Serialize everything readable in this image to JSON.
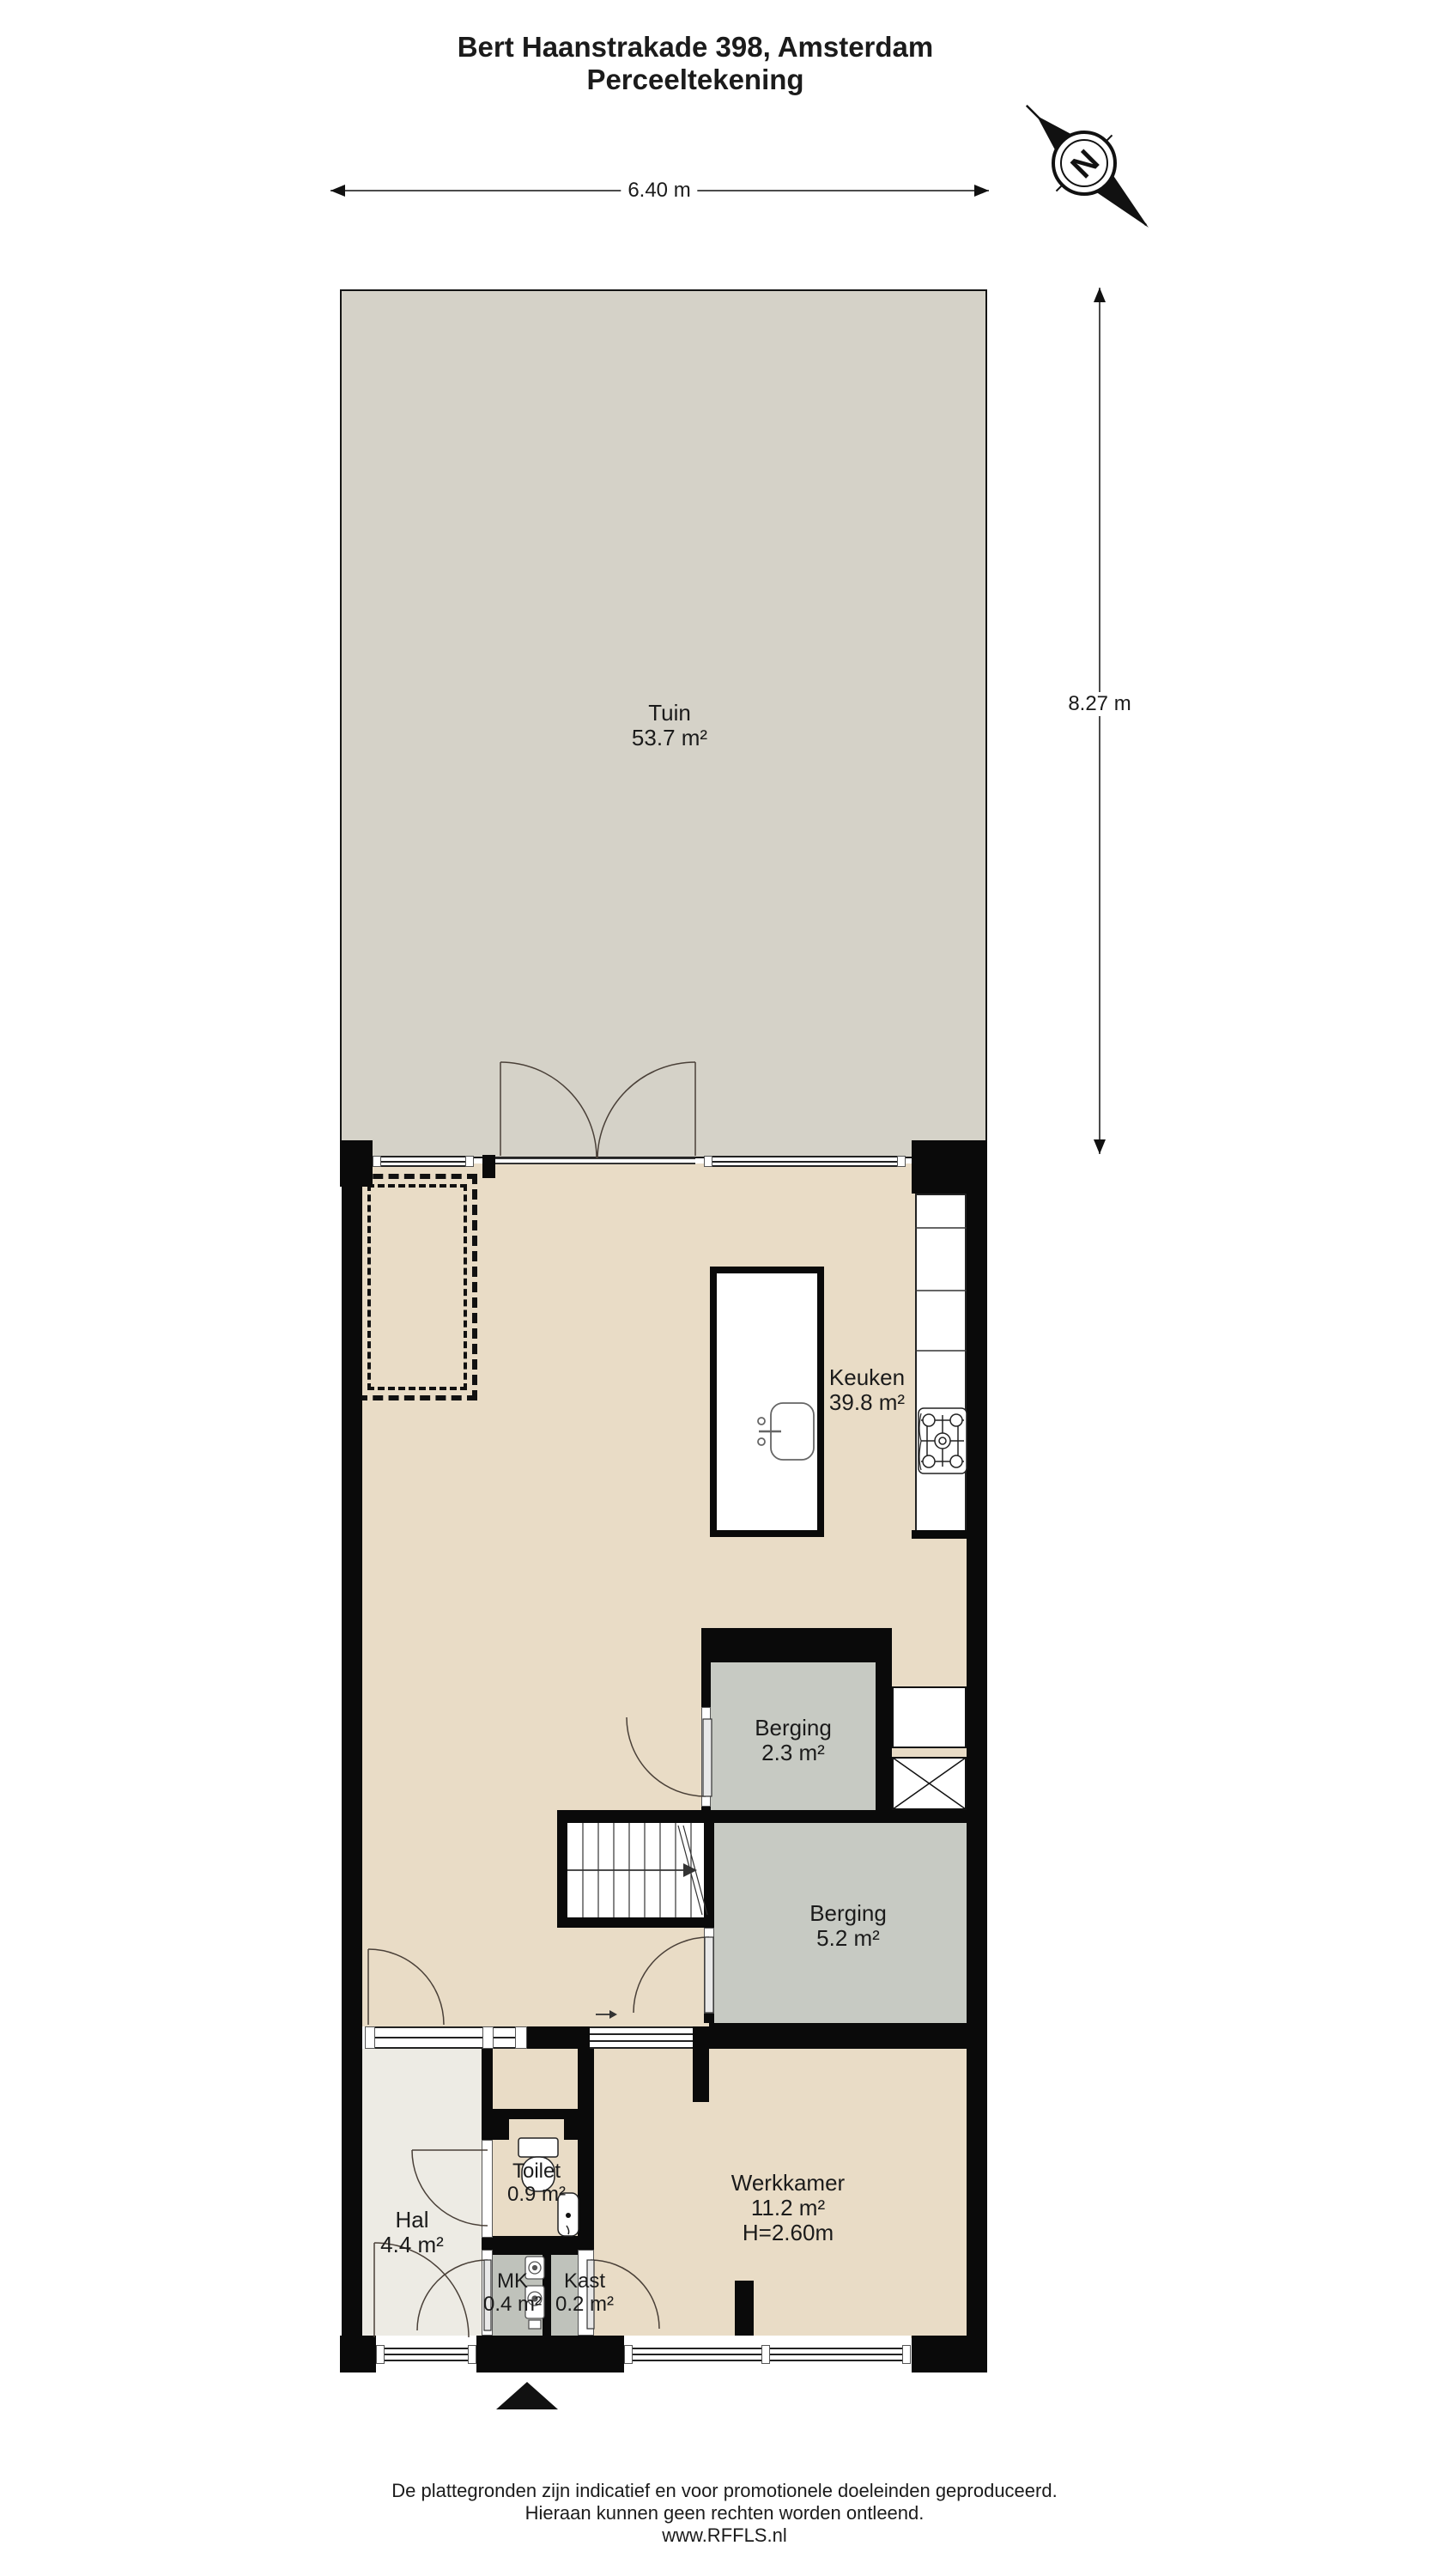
{
  "title": {
    "line1": "Bert Haanstrakade 398, Amsterdam",
    "line2": "Perceeltekening"
  },
  "dimensions": {
    "width_label": "6.40 m",
    "height_label": "8.27 m"
  },
  "compass": {
    "north_label": "N"
  },
  "rooms": {
    "tuin": {
      "name": "Tuin",
      "area": "53.7 m²"
    },
    "keuken": {
      "name": "Keuken",
      "area": "39.8 m²"
    },
    "berging_klein": {
      "name": "Berging",
      "area": "2.3 m²"
    },
    "berging_groot": {
      "name": "Berging",
      "area": "5.2 m²"
    },
    "hal": {
      "name": "Hal",
      "area": "4.4 m²"
    },
    "toilet": {
      "name": "Toilet",
      "area": "0.9 m²"
    },
    "mk": {
      "name": "MK",
      "area": "0.4 m²"
    },
    "kast": {
      "name": "Kast",
      "area": "0.2 m²"
    },
    "werkkamer": {
      "name": "Werkkamer",
      "area": "11.2 m²",
      "ceiling_height": "H=2.60m"
    }
  },
  "footer": {
    "line1": "De plattegronden zijn indicatief en voor promotionele doeleinden geproduceerd.",
    "line2": "Hieraan kunnen geen rechten worden ontleend.",
    "line3": "www.RFFLS.nl"
  },
  "colors": {
    "wall": "#0a0a0a",
    "garden": "#d5d2c8",
    "floor": "#e9dcc6",
    "hal": "#edebe4",
    "storage": "#c7cac3",
    "closet": "#bfc2bb",
    "line": "#333333"
  }
}
